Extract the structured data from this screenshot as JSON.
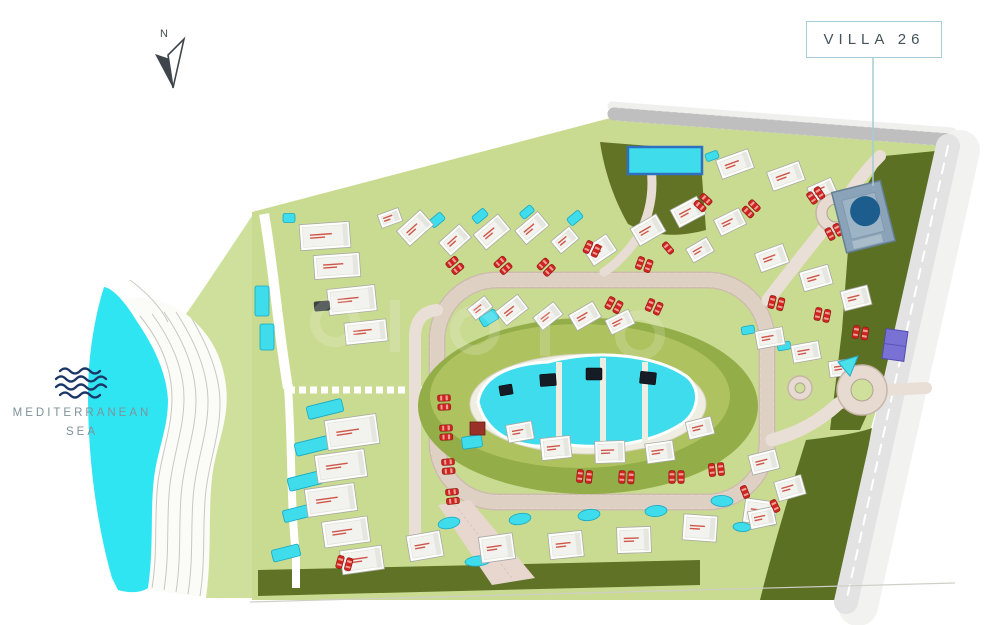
{
  "title_callout": {
    "label": "VILLA 26"
  },
  "compass": {
    "label": "N"
  },
  "sea": {
    "line1": "MEDITERRANEAN",
    "line2": "SEA"
  },
  "palette": {
    "sea_cyan": "#2fe5f2",
    "pool_cyan": "#3fdcec",
    "pool_stroke": "#17a9c6",
    "lawn_green": "#c9db90",
    "coast_green": "#cfe09c",
    "olive_dark": "#5f7226",
    "park_olive": "#93ad48",
    "road_paver": "#eadfd6",
    "road_gray": "#d8d8d8",
    "villa_white": "#fdfdfb",
    "accent_red": "#cf2420",
    "highlight_blue": "#8ba3b8",
    "highlight_pool_blue": "#1c5d8d",
    "callout_border": "#a9ccd9",
    "court_purple": "#7a71d4",
    "wave_navy": "#1d3668"
  },
  "map": {
    "villas": [
      [
        415,
        228,
        32,
        20,
        -42
      ],
      [
        455,
        240,
        28,
        18,
        -42
      ],
      [
        492,
        232,
        32,
        20,
        -40
      ],
      [
        532,
        228,
        30,
        18,
        -40
      ],
      [
        565,
        240,
        24,
        16,
        -40
      ],
      [
        600,
        250,
        28,
        20,
        -34
      ],
      [
        648,
        230,
        30,
        20,
        -30
      ],
      [
        688,
        212,
        30,
        20,
        -28
      ],
      [
        735,
        164,
        34,
        20,
        -20
      ],
      [
        786,
        176,
        34,
        20,
        -20
      ],
      [
        730,
        222,
        28,
        18,
        -26
      ],
      [
        700,
        250,
        24,
        16,
        -30
      ],
      [
        772,
        258,
        30,
        20,
        -20
      ],
      [
        816,
        278,
        30,
        20,
        -16
      ],
      [
        856,
        298,
        28,
        20,
        -14
      ],
      [
        822,
        190,
        26,
        16,
        -24
      ],
      [
        512,
        310,
        28,
        18,
        -38
      ],
      [
        548,
        316,
        26,
        16,
        -38
      ],
      [
        585,
        316,
        28,
        18,
        -30
      ],
      [
        620,
        322,
        26,
        16,
        -26
      ],
      [
        480,
        308,
        22,
        14,
        -38
      ],
      [
        325,
        236,
        50,
        26,
        -4
      ],
      [
        337,
        266,
        46,
        24,
        -4
      ],
      [
        352,
        300,
        48,
        26,
        -6
      ],
      [
        366,
        332,
        42,
        22,
        -6
      ],
      [
        352,
        432,
        52,
        30,
        -8
      ],
      [
        341,
        466,
        50,
        28,
        -8
      ],
      [
        331,
        500,
        50,
        28,
        -8
      ],
      [
        346,
        532,
        46,
        26,
        -8
      ],
      [
        362,
        560,
        42,
        24,
        -8
      ],
      [
        390,
        218,
        22,
        14,
        -20
      ],
      [
        425,
        546,
        34,
        26,
        -10
      ],
      [
        497,
        548,
        34,
        26,
        -8
      ],
      [
        566,
        545,
        34,
        26,
        -6
      ],
      [
        634,
        540,
        34,
        26,
        -2
      ],
      [
        700,
        528,
        34,
        26,
        4
      ],
      [
        760,
        512,
        32,
        24,
        8
      ],
      [
        556,
        448,
        30,
        22,
        -6
      ],
      [
        610,
        452,
        30,
        22,
        -2
      ],
      [
        660,
        452,
        28,
        20,
        -8
      ],
      [
        700,
        428,
        26,
        18,
        -14
      ],
      [
        520,
        432,
        26,
        18,
        -10
      ],
      [
        764,
        462,
        28,
        20,
        -14
      ],
      [
        790,
        488,
        28,
        20,
        -16
      ],
      [
        762,
        518,
        26,
        18,
        -12
      ],
      [
        770,
        338,
        28,
        18,
        -10
      ],
      [
        806,
        352,
        28,
        18,
        -10
      ],
      [
        842,
        368,
        26,
        16,
        -8
      ]
    ],
    "pools": [
      [
        437,
        220,
        15,
        9,
        -40,
        "r"
      ],
      [
        480,
        216,
        15,
        9,
        -40,
        "r"
      ],
      [
        527,
        212,
        14,
        8,
        -40,
        "r"
      ],
      [
        575,
        218,
        15,
        9,
        -40,
        "r"
      ],
      [
        289,
        218,
        12,
        9,
        0,
        "r"
      ],
      [
        262,
        301,
        14,
        30,
        0,
        "r"
      ],
      [
        267,
        337,
        14,
        26,
        0,
        "r"
      ],
      [
        325,
        409,
        36,
        13,
        -14,
        "r"
      ],
      [
        312,
        446,
        34,
        13,
        -14,
        "r"
      ],
      [
        305,
        481,
        34,
        13,
        -14,
        "r"
      ],
      [
        299,
        513,
        32,
        12,
        -14,
        "r"
      ],
      [
        286,
        553,
        28,
        12,
        -14,
        "r"
      ],
      [
        489,
        318,
        18,
        11,
        -32,
        "r"
      ],
      [
        472,
        442,
        20,
        12,
        -8,
        "r"
      ],
      [
        449,
        523,
        22,
        11,
        -12,
        "e"
      ],
      [
        520,
        519,
        22,
        11,
        -10,
        "e"
      ],
      [
        589,
        515,
        22,
        11,
        -8,
        "e"
      ],
      [
        656,
        511,
        22,
        11,
        -4,
        "e"
      ],
      [
        722,
        501,
        22,
        11,
        2,
        "e"
      ],
      [
        786,
        489,
        20,
        10,
        6,
        "e"
      ],
      [
        478,
        561,
        26,
        10,
        -6,
        "e"
      ],
      [
        742,
        527,
        18,
        9,
        4,
        "e"
      ],
      [
        748,
        330,
        13,
        8,
        -10,
        "r"
      ],
      [
        784,
        346,
        13,
        8,
        -10,
        "r"
      ],
      [
        712,
        156,
        13,
        8,
        -20,
        "r"
      ]
    ],
    "main_pool": {
      "x": 628,
      "y": 147,
      "w": 74,
      "h": 27
    },
    "cars": [
      [
        452,
        262,
        50,
        0
      ],
      [
        500,
        262,
        48,
        0
      ],
      [
        543,
        264,
        45,
        0
      ],
      [
        588,
        247,
        25,
        0
      ],
      [
        640,
        263,
        20,
        0
      ],
      [
        610,
        303,
        28,
        0
      ],
      [
        650,
        305,
        24,
        0
      ],
      [
        700,
        206,
        -48,
        0
      ],
      [
        748,
        212,
        -45,
        0
      ],
      [
        812,
        198,
        -34,
        0
      ],
      [
        830,
        234,
        -28,
        0
      ],
      [
        772,
        302,
        14,
        0
      ],
      [
        818,
        314,
        12,
        0
      ],
      [
        856,
        332,
        10,
        0
      ],
      [
        444,
        398,
        88,
        0
      ],
      [
        446,
        428,
        88,
        0
      ],
      [
        448,
        462,
        86,
        0
      ],
      [
        452,
        492,
        84,
        0
      ],
      [
        340,
        562,
        15,
        0
      ],
      [
        580,
        476,
        6,
        0
      ],
      [
        622,
        477,
        3,
        0
      ],
      [
        672,
        477,
        0,
        0
      ],
      [
        712,
        470,
        -6,
        0
      ],
      [
        668,
        248,
        -40,
        1
      ],
      [
        745,
        492,
        -22,
        1
      ],
      [
        775,
        506,
        -26,
        1
      ]
    ],
    "pavilions": [
      [
        548,
        380,
        16,
        12,
        -4
      ],
      [
        594,
        374,
        16,
        12,
        0
      ],
      [
        648,
        378,
        16,
        12,
        6
      ],
      [
        506,
        390,
        13,
        10,
        -10
      ]
    ],
    "roundabouts": [
      [
        836,
        213,
        20,
        9
      ],
      [
        862,
        390,
        25,
        11
      ],
      [
        800,
        388,
        12,
        5
      ]
    ]
  }
}
